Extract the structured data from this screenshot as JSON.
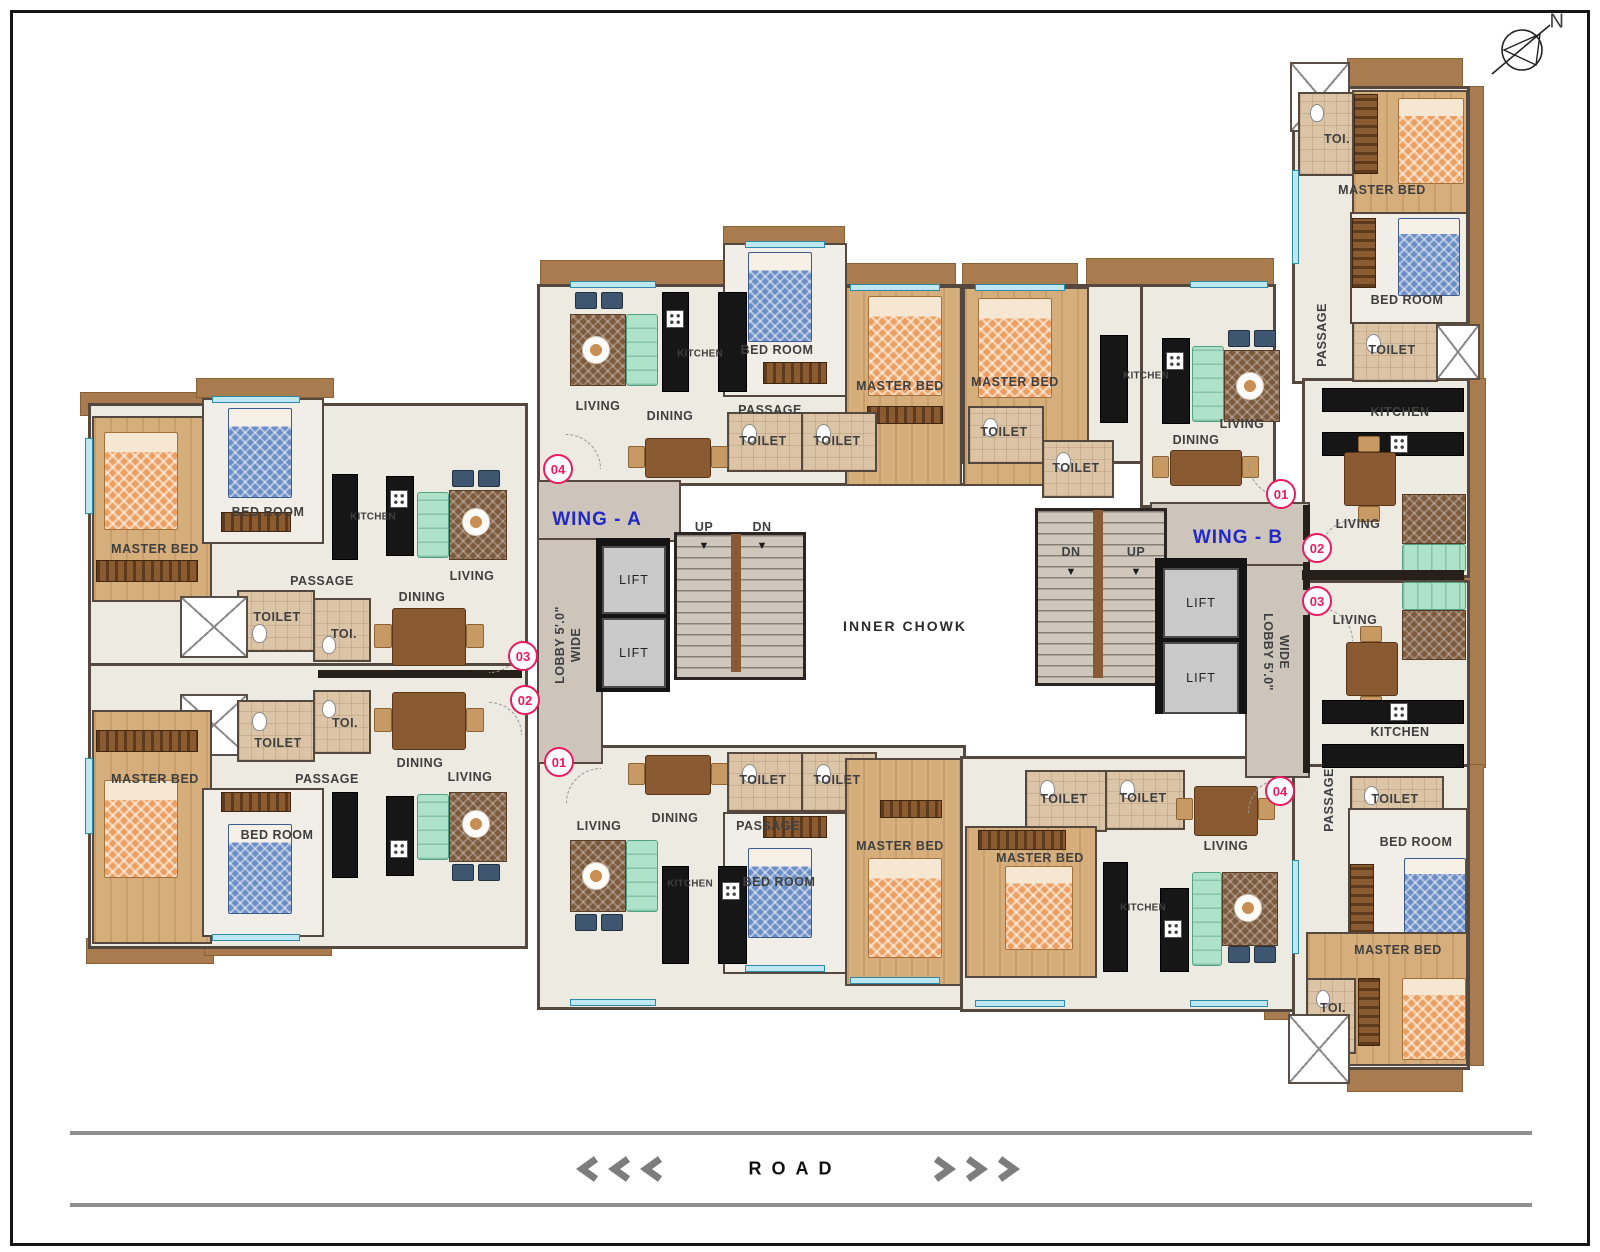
{
  "compass": {
    "north": "N"
  },
  "road": {
    "label": "ROAD"
  },
  "wings": {
    "a": "WING - A",
    "b": "WING - B"
  },
  "core": {
    "lift": "LIFT",
    "up": "UP",
    "dn": "DN",
    "lobby_line1": "LOBBY 5'.0\"",
    "lobby_line2": "WIDE",
    "inner_chowk": "INNER CHOWK"
  },
  "units": {
    "u1": "01",
    "u2": "02",
    "u3": "03",
    "u4": "04"
  },
  "rooms": {
    "master_bed": "MASTER BED",
    "bed_room": "BED ROOM",
    "living": "LIVING",
    "dining": "DINING",
    "kitchen": "KITCHEN",
    "passage": "PASSAGE",
    "toilet": "TOILET",
    "toi": "TOI."
  },
  "icons": {
    "arrow_down": "▼"
  },
  "colors": {
    "accent_pink": "#EA1A5F",
    "wing_blue": "#2329C8",
    "balcony_brown": "#A87C4E",
    "window_cyan": "#BDE8F3"
  }
}
